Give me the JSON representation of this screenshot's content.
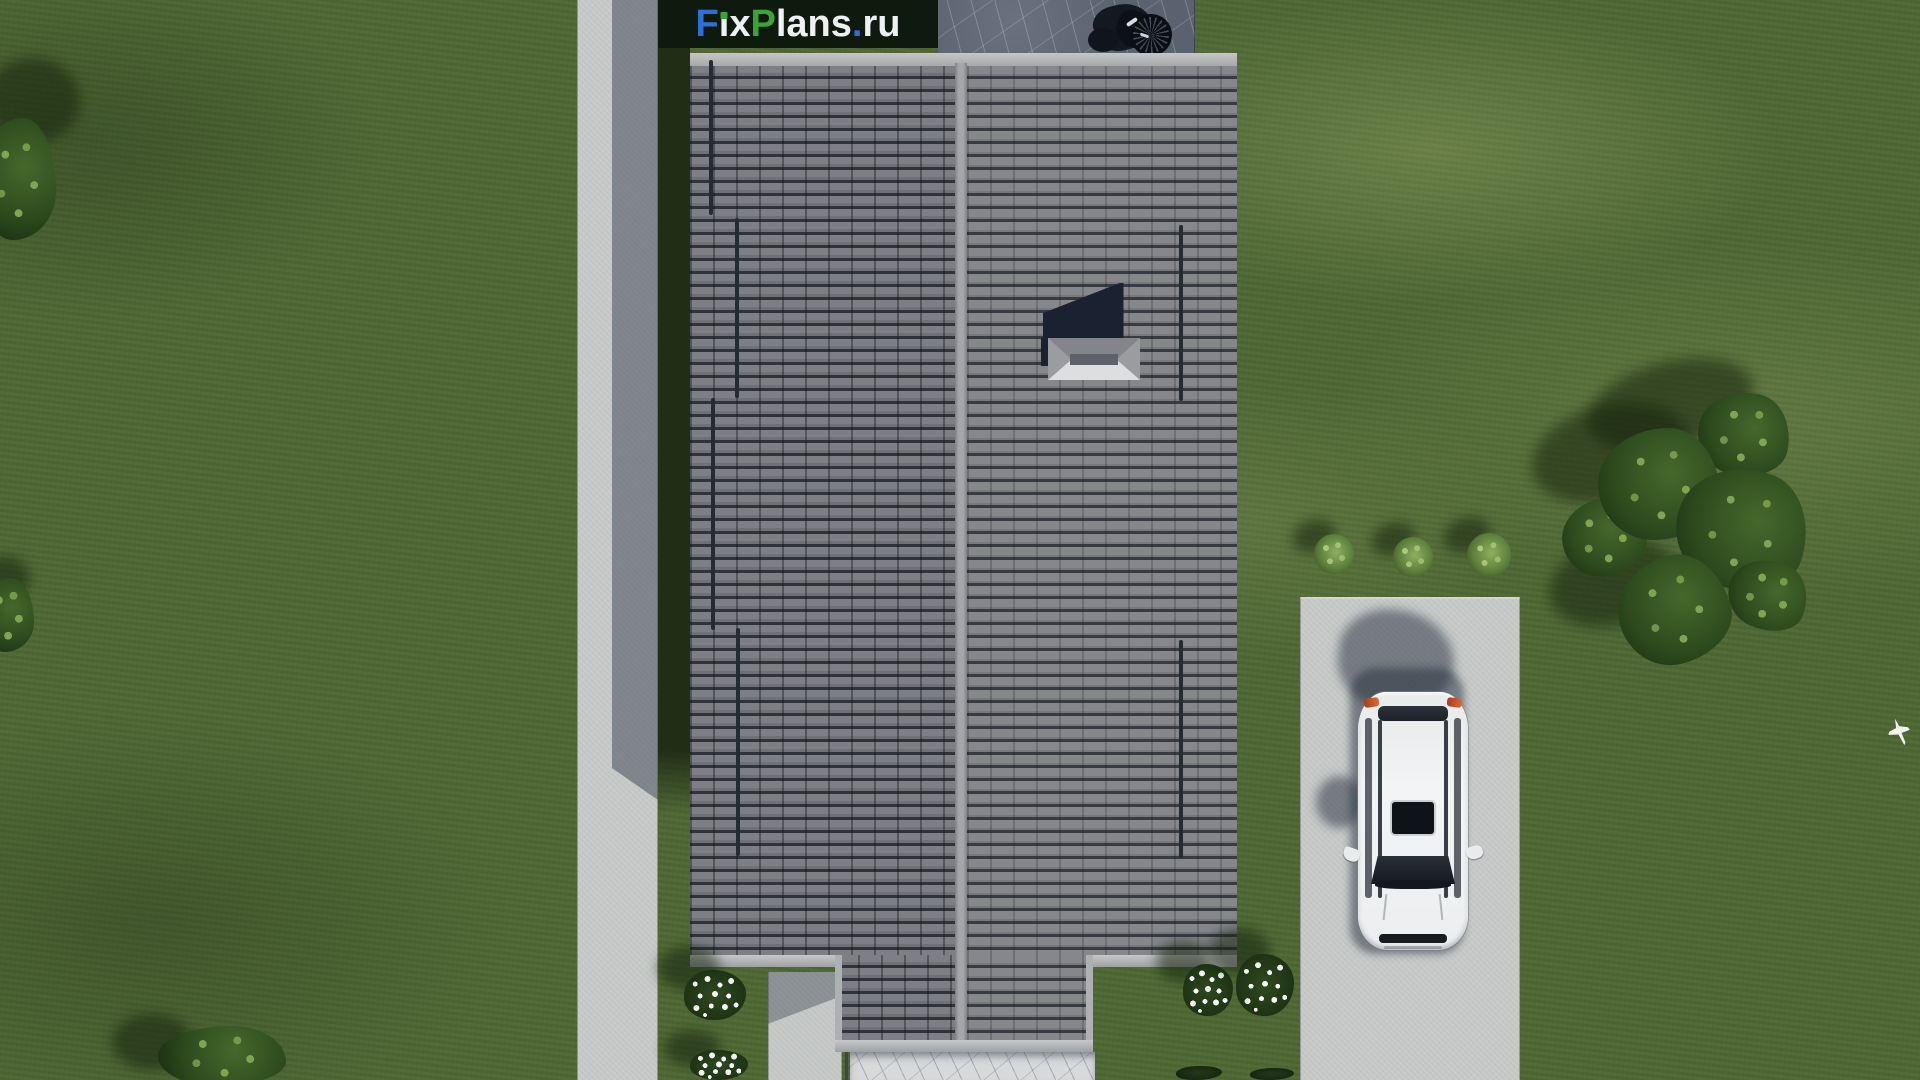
{
  "watermark": {
    "text": "FixPlans.ru",
    "background": "#0e1a0e",
    "letters": [
      {
        "ch": "F",
        "color": "#2f6fd8"
      },
      {
        "ch": "i",
        "color": "#eef1f4",
        "dot": "#3ba437"
      },
      {
        "ch": "x",
        "color": "#eef1f4"
      },
      {
        "ch": "P",
        "color": "#3ba437"
      },
      {
        "ch": "l",
        "color": "#eef1f4"
      },
      {
        "ch": "a",
        "color": "#eef1f4"
      },
      {
        "ch": "n",
        "color": "#eef1f4"
      },
      {
        "ch": "s",
        "color": "#eef1f4"
      },
      {
        "ch": ".",
        "color": "#2f6fd8"
      },
      {
        "ch": "r",
        "color": "#eef1f4"
      },
      {
        "ch": "u",
        "color": "#eef1f4"
      }
    ]
  },
  "palette": {
    "grass": "#4f6834",
    "grass_shadow": "#2b3d21",
    "concrete": "#c7cac8",
    "concrete_shadow": "#858b91",
    "roof_tile": "#75777b",
    "roof_tile_dark": "#34373c",
    "roof_ridge": "#9b9da1",
    "roof_fascia": "#b3b5b7",
    "stone": "#5a6270",
    "marble": "#d7d9da",
    "car_body": "#eef0f1",
    "car_glass": "#1c2127",
    "foliage_dark": "#24381b",
    "foliage_mid": "#3f5e2c",
    "foliage_light": "#86a85f",
    "flower_white": "#f6f7f2",
    "watermark_bg": "#0e1a0e"
  },
  "scene": {
    "view": "aerial-top-down-render",
    "house": {
      "roof_faces": 2,
      "ridge_orientation": "vertical",
      "chimney": true,
      "porch_extension": true
    },
    "car": {
      "type": "suv-top-view",
      "color": "white",
      "sunroof": true,
      "parked_on": "driveway"
    },
    "paths": {
      "sidewalk_left": true,
      "driveway_right": true,
      "stone_walkway_bottom": true,
      "garden_path": true,
      "stone_patio_top": true
    },
    "vegetation": {
      "round_bushes_row": 3,
      "flower_bushes": 4,
      "tree_cluster_right": 6,
      "tree_top_left": 1,
      "tree_bottom_left": 1,
      "bush_left_edge": 1
    },
    "extras": {
      "grill_on_patio": true,
      "white_bird": true
    }
  }
}
